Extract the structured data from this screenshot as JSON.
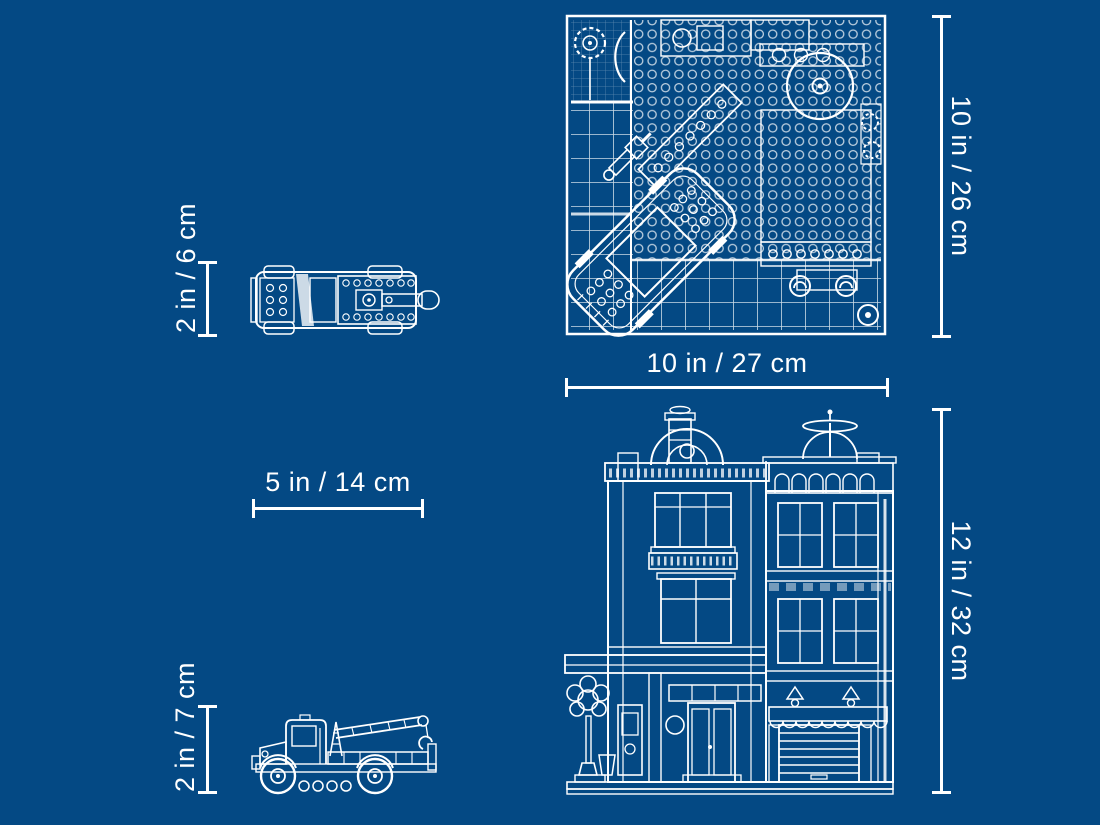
{
  "page": {
    "description": "LEGO-style blueprint diagram with product dimensions",
    "background_color": "#044984",
    "line_color": "#ffffff"
  },
  "views": {
    "building_top": "building top view",
    "building_front": "building front view",
    "truck_top": "tow truck top view",
    "truck_side": "tow truck side view"
  },
  "dimensions": {
    "building_depth": "10 in / 26 cm",
    "building_width": "10 in / 27 cm",
    "building_height": "12 in / 32 cm",
    "truck_width": "2 in / 6 cm",
    "truck_length": "5 in / 14 cm",
    "truck_height": "2 in / 7 cm"
  }
}
